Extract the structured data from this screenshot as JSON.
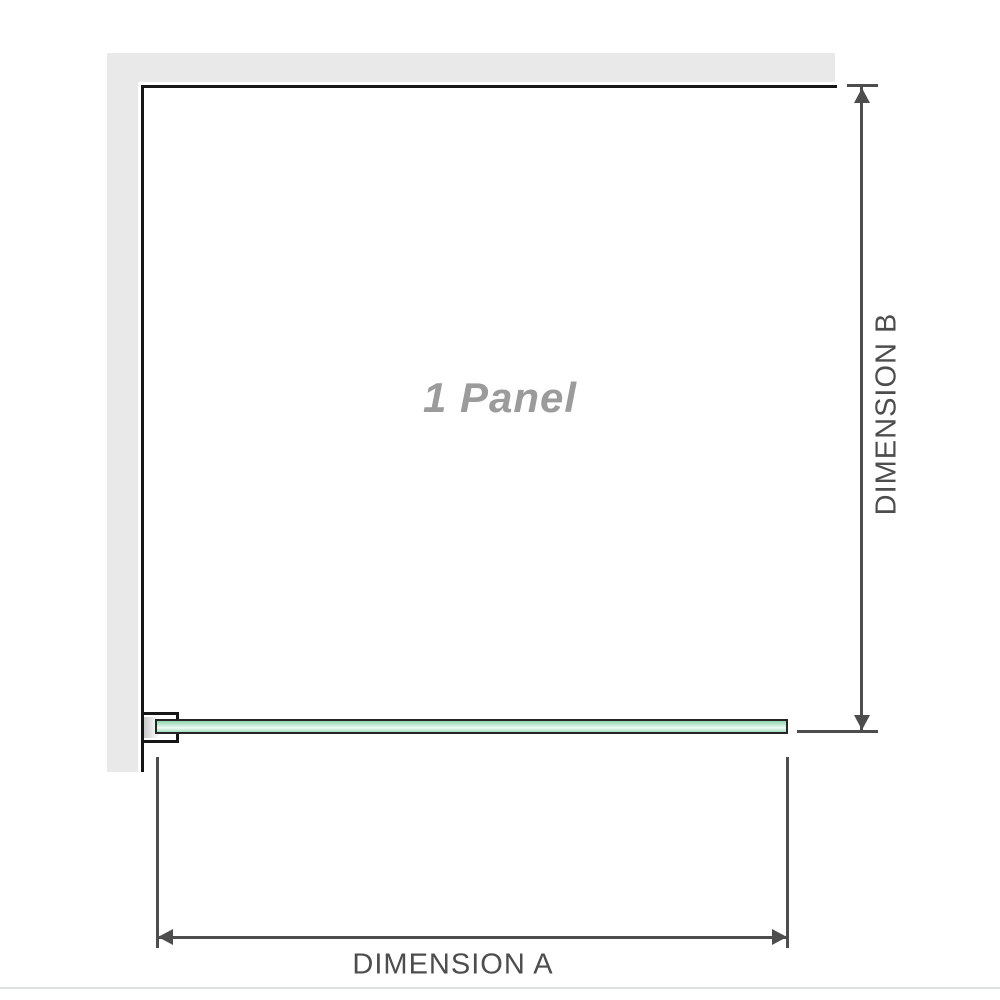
{
  "diagram": {
    "panel_label": "1 Panel",
    "dimension_a_label": "DIMENSION A",
    "dimension_b_label": "DIMENSION B"
  },
  "colors": {
    "wall": "#e9e9e9",
    "outline": "#161616",
    "dimension": "#4d4d4d",
    "label_gray": "#9b9b9b",
    "glass_border": "#252525",
    "glass_1": "#8fd3ad",
    "glass_2": "#c9ecd9",
    "glass_3": "#eefaf3",
    "glass_4": "#a6dec0",
    "bottom_rule": "#dfe3df"
  }
}
